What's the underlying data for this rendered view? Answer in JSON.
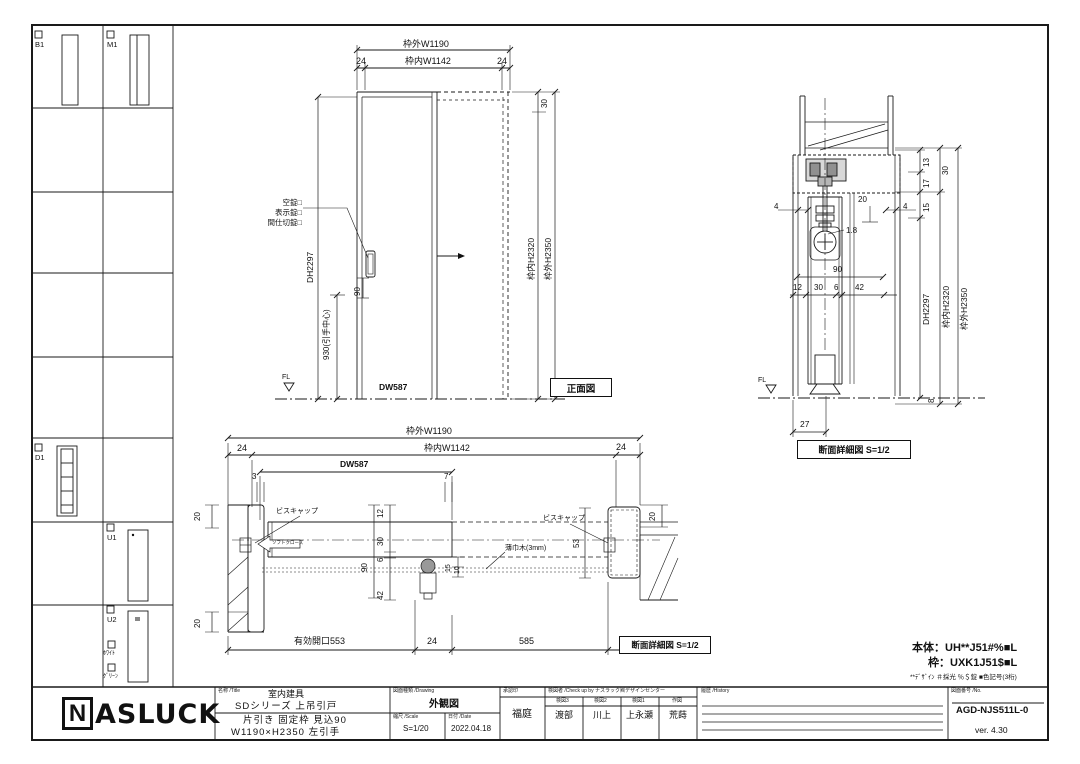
{
  "sidebar": {
    "items": [
      {
        "label": "B1"
      },
      {
        "label": "M1"
      },
      {
        "label": "D1"
      },
      {
        "label": "U1"
      },
      {
        "label": "U2"
      }
    ],
    "color_options": [
      {
        "label": "ﾎﾜｲﾄ"
      },
      {
        "label": "ｸﾞﾘｰﾝ"
      }
    ]
  },
  "front_view": {
    "title": "正面図",
    "dims": {
      "ow": "枠外W1190",
      "iw": "枠内W1142",
      "l24": "24",
      "r24": "24",
      "d30": "30",
      "dh": "DH2297",
      "d90": "90",
      "handle_center": "930(引手中心)",
      "dw": "DW587",
      "inner_h": "枠内H2320",
      "outer_h": "枠外H2350"
    },
    "labels": {
      "lock1": "空錠□",
      "lock2": "表示錠□",
      "lock3": "間仕切錠□",
      "fl": "FL"
    }
  },
  "section_view": {
    "title": "断面詳細図 S=1/2",
    "dims": {
      "d13": "13",
      "d17": "17",
      "d30": "30",
      "d15": "15",
      "l4": "4",
      "r4": "4",
      "d20": "20",
      "d1_8": "1.8",
      "d90": "90",
      "d12": "12",
      "d30b": "30",
      "d6": "6",
      "d42": "42",
      "dh": "DH2297",
      "inner_h": "枠内H2320",
      "outer_h": "枠外H2350",
      "d8": "8",
      "d27": "27"
    },
    "labels": {
      "fl": "FL"
    }
  },
  "plan_view": {
    "title": "断面詳細図 S=1/2",
    "dims": {
      "ow": "枠外W1190",
      "iw": "枠内W1142",
      "l24": "24",
      "r24": "24",
      "dw": "DW587",
      "d3": "3",
      "d7": "7",
      "d20a": "20",
      "d20b": "20",
      "d20c": "20",
      "d12": "12",
      "d30": "30",
      "d6": "6",
      "d42": "42",
      "d90": "90",
      "d15": "15",
      "d10": "10",
      "d53": "53",
      "opening": "有効開口553",
      "d24": "24",
      "d585": "585"
    },
    "labels": {
      "screw_cap_left": "ビスキャップ",
      "screw_cap_right": "ビスキャップ",
      "soft_close": "ソフトクローズ",
      "baseboard": "薄巾木(3mm)"
    }
  },
  "product_code": {
    "body": "本体：UH**J51#%■L",
    "frame": "枠：UXK1J51$■L",
    "note": "**ﾃﾞｻﾞｲﾝ ＃採光 ％＄錠 ■色記号(3桁)"
  },
  "title_block": {
    "logo_n": "N",
    "logo_rest": "ASLUCK",
    "name_label": "名称 /Title",
    "name1": "室内建具",
    "name2": "SDシリーズ 上吊引戸",
    "spec1": "片引き 固定枠 見込90",
    "spec2": "W1190×H2350 左引手",
    "drawing_label": "図面種類 /Drawing",
    "drawing": "外観図",
    "scale_label": "縮尺 /Scale",
    "scale": "S=1/20",
    "date_label": "日付 /Date",
    "date": "2022.04.18",
    "approval_label": "承認印",
    "approval": "福庭",
    "check_label": "検図者 /Check up by ナスラック㈱デザインセンター",
    "checks": [
      {
        "role": "検図3",
        "name": "渡部"
      },
      {
        "role": "検図2",
        "name": "川上"
      },
      {
        "role": "検図1",
        "name": "上永瀬"
      },
      {
        "role": "作図",
        "name": "荒蒔"
      }
    ],
    "history_label": "履歴 /History",
    "no_label": "図面番号 /No.",
    "number": "AGD-NJS511L-0",
    "version": "ver. 4.30"
  }
}
